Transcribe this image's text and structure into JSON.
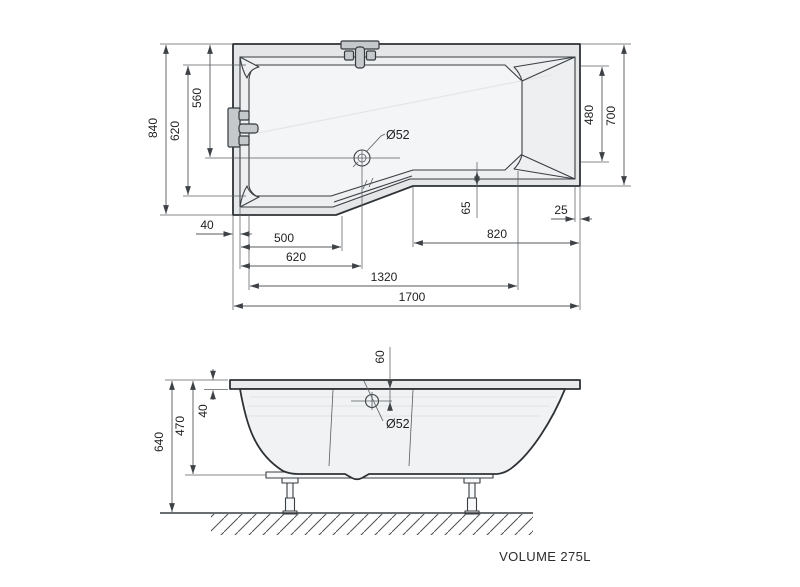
{
  "top_view": {
    "drain_label": "Ø52",
    "dims": {
      "overall_height": "840",
      "basin_height": "620",
      "drain_from_top": "560",
      "headrest_width": "480",
      "right_height": "700",
      "rim_left": "40",
      "foot_width": "500",
      "drain_from_left": "620",
      "basin_length": "1320",
      "overall_length": "1700",
      "right_section_length": "820",
      "step_depth": "65",
      "rim_right": "25"
    }
  },
  "side_view": {
    "drain_label": "Ø52",
    "dims": {
      "overall_height": "640",
      "shell_height": "470",
      "rim_thickness": "40",
      "drain_offset": "60"
    }
  },
  "footer": {
    "volume_label": "VOLUME 275L"
  },
  "colors": {
    "outline": "#2e3236",
    "dimension": "#54585c",
    "fill_light": "#e5e7e9",
    "fill_lighter": "#f4f5f7",
    "background": "#ffffff"
  }
}
